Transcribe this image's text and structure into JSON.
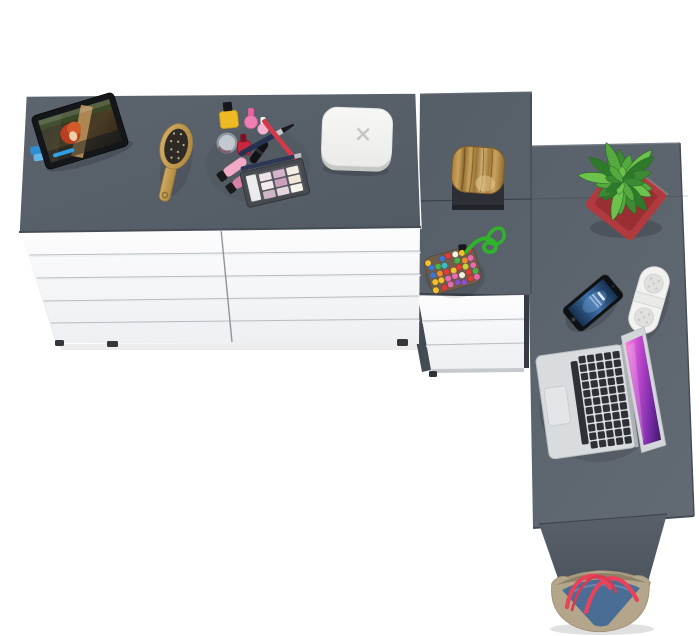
{
  "meta": {
    "type": "product-photo",
    "subject": "Top-down view of a white ten-drawer double dresser with grey top joined to a grey L-shaped corner desk with three-drawer pedestal, styled with accessories",
    "background": "#ffffff"
  },
  "colors": {
    "background": "#ffffff",
    "dresser_top": "#58606a",
    "desk_edge": "#454c54",
    "groove_dark": "#b6bcc2",
    "groove_light": "#eef0f2",
    "pedestal_shadow": "#343b42",
    "foot_dark": "#33383d",
    "stump_base": "#2c3036",
    "pot_red": "#b13a3e",
    "pot_red_dark": "#992f33",
    "leaf_greens": [
      "#3c8a33",
      "#55aa3f",
      "#6cc24c",
      "#2f7a2a"
    ],
    "cord_green": "#2fb32a",
    "pouch_base": "#6f5d49",
    "bead_colors": [
      "#e23b3b",
      "#f2c12e",
      "#3a78d4",
      "#47b44a",
      "#e86ab0",
      "#8a52c2",
      "#f08a2e",
      "#f5f0e6",
      "#35c0c8",
      "#c8d23f"
    ],
    "phone_body": "#0e1013",
    "speaker_white": "#f2f2f0",
    "laptop_key": "#2d3034",
    "box_white": "#f4f4f2",
    "box_mark": "#c5c5c3",
    "bag_tan": "#b3a68a",
    "bag_denim": "#4a6d96",
    "bag_handle": "#e8435a",
    "tablet_frame": "#141619",
    "progress_blue": "#2da0e8",
    "lipstick_pink": "#f2a9c6",
    "lipstick_rose": "#d87fa4",
    "polish_yellow": "#edba25",
    "polish_red": "#c52840",
    "polish_pink": "#ef7fb2"
  },
  "counts": {
    "dresser_drawer_rows": 5,
    "dresser_drawer_columns": 2,
    "pedestal_drawers": 3,
    "keyboard_key_columns": 6,
    "keyboard_key_rows": 11,
    "bead_rows": 5,
    "bead_columns": 7,
    "leaf_count": 18
  },
  "objects": {
    "furniture": [
      "dresser-top",
      "dresser-drawers",
      "desk-return",
      "desk-pedestal-drawers",
      "desk-side-panel"
    ],
    "accessories": [
      "tablet-with-movie",
      "wooden-hairbrush",
      "makeup-set",
      "eyeshadow-palette",
      "white-media-box",
      "wood-stump-decor",
      "potted-plant",
      "beaded-pouch",
      "smartphone",
      "pill-speaker",
      "open-laptop",
      "tote-bag"
    ]
  }
}
